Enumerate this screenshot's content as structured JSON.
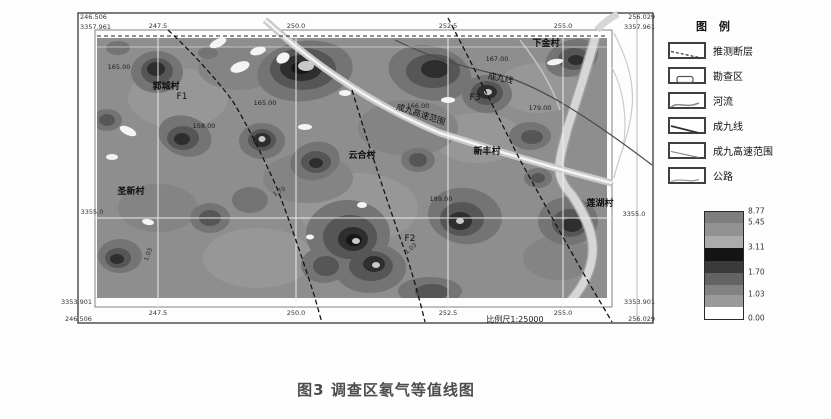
{
  "figure": {
    "caption": "图3 调查区氡气等值线图"
  },
  "map": {
    "scale_text": "比例尺1:25000",
    "corners": {
      "top_left": {
        "easting": "246.506",
        "northing": "3357.961"
      },
      "top_right": {
        "easting": "256.029",
        "northing": "3357.961"
      },
      "bottom_left": {
        "easting": "246.506",
        "northing": "3353.901"
      },
      "bottom_right": {
        "easting": "256.029",
        "northing": "3353.901"
      }
    },
    "grid_x_labels": [
      "247.5",
      "250.0",
      "252.5",
      "255.0"
    ],
    "grid_y_label_left": "3355.0",
    "grid_y_label_right": "3355.0",
    "villages": [
      "郭城村",
      "下金村",
      "云合村",
      "新丰村",
      "圣新村",
      "莲湖村"
    ],
    "fault_labels": [
      "F1",
      "F2",
      "F3"
    ],
    "line_labels": {
      "railway": "成九线",
      "highway": "成九高速范围"
    },
    "value_labels": [
      "165.00",
      "158.00",
      "165.00",
      "166.00",
      "167.00",
      "179.00",
      "189.00"
    ],
    "contour_labels": [
      "1.03",
      "1.70",
      "1.03"
    ],
    "palette": {
      "base_gray": "#8e8e8e",
      "dark1": "#747474",
      "dark2": "#565656",
      "dark3": "#2e2e2e",
      "darkest": "#161616",
      "river": "#d6d6d6",
      "white_patch": "#f4f4f4"
    }
  },
  "legend": {
    "title": "图 例",
    "items": [
      {
        "label": "推测断层"
      },
      {
        "label": "勘查区"
      },
      {
        "label": "河流"
      },
      {
        "label": "成九线"
      },
      {
        "label": "成九高速范围"
      },
      {
        "label": "公路"
      }
    ],
    "scale": {
      "labels": [
        "8.77",
        "5.45",
        "3.11",
        "1.70",
        "1.03",
        "0.00"
      ],
      "colors": [
        "#7e7e7e",
        "#929292",
        "#ababab",
        "#141414",
        "#3a3a3a",
        "#636363",
        "#828282",
        "#9b9b9b",
        "#ffffff"
      ]
    }
  }
}
